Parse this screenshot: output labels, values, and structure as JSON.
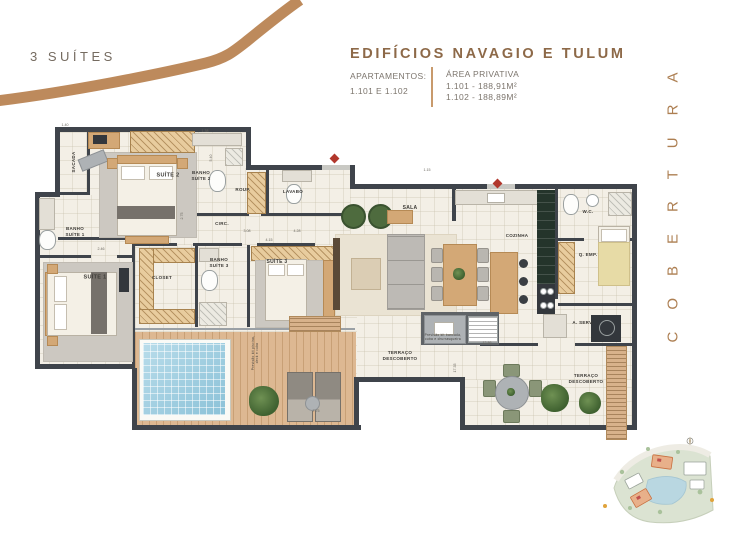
{
  "header": {
    "plan_type": "3 SUÍTES",
    "title": "EDIFÍCIOS NAVAGIO E TULUM",
    "apartments_label": "APARTAMENTOS:",
    "apartments_value": "1.101 E 1.102",
    "area_label": "ÁREA PRIVATIVA",
    "area_line1": "1.101 - 188,91M²",
    "area_line2": "1.102 - 188,89M²"
  },
  "side_label": "COBERTURA",
  "colors": {
    "brand_swoosh": "#bd8a5c",
    "title": "#8d6948",
    "text_gray": "#756b60",
    "wall": "#3f444b",
    "floor": "#f3efe6",
    "wood_deck": "#ddb892",
    "pool": "#9ccde0",
    "accent_red": "#b1372c"
  },
  "floorplan": {
    "labels": [
      {
        "text": "SACADA",
        "x": 39,
        "y": 44,
        "rot": -90,
        "size": 4.5
      },
      {
        "text": "SUÍTE 2",
        "x": 133,
        "y": 58,
        "size": 5.5
      },
      {
        "text": "BANHO\nSUÍTE 2",
        "x": 166,
        "y": 58,
        "size": 4.5
      },
      {
        "text": "ROUP.",
        "x": 208,
        "y": 72,
        "size": 4.5
      },
      {
        "text": "LAVABO",
        "x": 258,
        "y": 74,
        "size": 4.5
      },
      {
        "text": "CIRC.",
        "x": 187,
        "y": 106,
        "size": 4.5
      },
      {
        "text": "SALA",
        "x": 375,
        "y": 90,
        "size": 5
      },
      {
        "text": "COZINHA",
        "x": 482,
        "y": 118,
        "size": 4.5
      },
      {
        "text": "W.C.",
        "x": 553,
        "y": 94,
        "size": 4.5
      },
      {
        "text": "Q. EMP.",
        "x": 553,
        "y": 137,
        "size": 4.5
      },
      {
        "text": "A. SERV.",
        "x": 548,
        "y": 205,
        "size": 4.5
      },
      {
        "text": "BANHO\nSUÍTE 1",
        "x": 40,
        "y": 114,
        "size": 4.5
      },
      {
        "text": "SUÍTE 1",
        "x": 60,
        "y": 160,
        "size": 5.5
      },
      {
        "text": "CLOSET",
        "x": 127,
        "y": 160,
        "size": 4.5
      },
      {
        "text": "BANHO\nSUÍTE 3",
        "x": 184,
        "y": 145,
        "size": 4.5
      },
      {
        "text": "SUÍTE 3",
        "x": 242,
        "y": 144,
        "size": 5
      },
      {
        "text": "TERRAÇO\nDESCOBERTO",
        "x": 365,
        "y": 238,
        "size": 4.5
      },
      {
        "text": "TERRAÇO\nDESCOBERTO",
        "x": 551,
        "y": 261,
        "size": 4.5
      },
      {
        "text": "Previsão kit piscina,\ndeck e cuba",
        "x": 220,
        "y": 235,
        "rot": -90,
        "size": 3.2,
        "light": true
      },
      {
        "text": "Previsão kit bancada,\ncuba e churrasqueira",
        "x": 408,
        "y": 219,
        "size": 3.2,
        "light": true
      }
    ],
    "dims": [
      {
        "text": "1.40",
        "x": 30,
        "y": 7
      },
      {
        "text": "1.38",
        "x": 170,
        "y": 13
      },
      {
        "text": "5.40",
        "x": 176,
        "y": 40,
        "rot": -90
      },
      {
        "text": "1.15",
        "x": 392,
        "y": 52
      },
      {
        "text": "3.08",
        "x": 212,
        "y": 113
      },
      {
        "text": "4.28",
        "x": 262,
        "y": 113
      },
      {
        "text": "4.15",
        "x": 234,
        "y": 122
      },
      {
        "text": "2.75",
        "x": 147,
        "y": 98,
        "rot": -90
      },
      {
        "text": "2.46",
        "x": 66,
        "y": 131
      },
      {
        "text": "17.35",
        "x": 420,
        "y": 250,
        "rot": -90
      },
      {
        "text": "7.75",
        "x": 281,
        "y": 293
      },
      {
        "text": "12.86",
        "x": 452,
        "y": 225
      }
    ]
  }
}
